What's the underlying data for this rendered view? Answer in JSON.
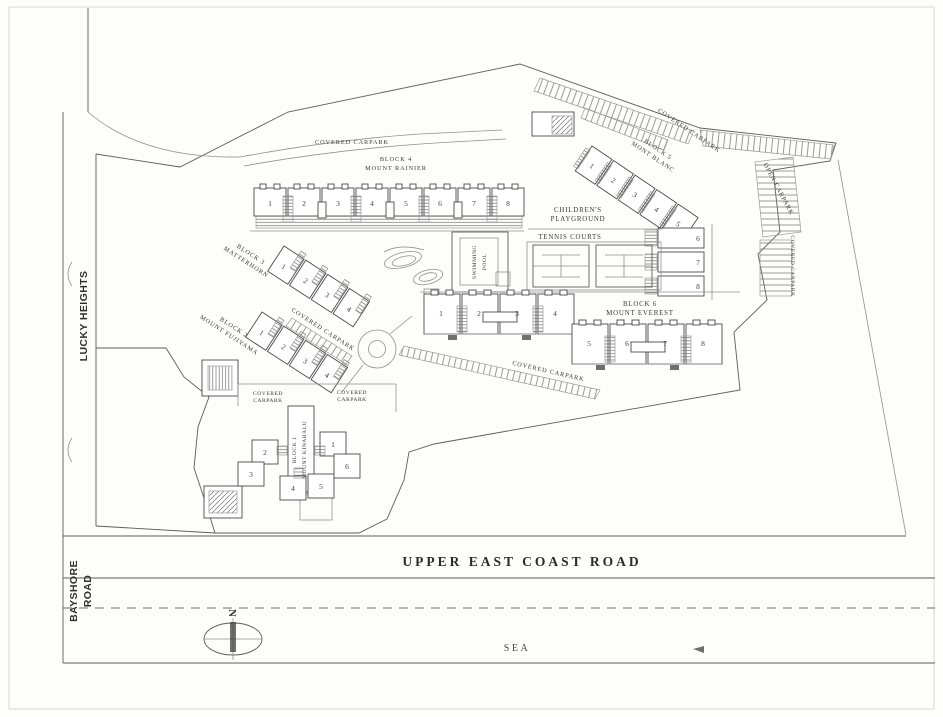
{
  "plan": {
    "roads": {
      "upper_east_coast_road": "UPPER EAST COAST ROAD",
      "bayshore_l1": "BAYSHORE",
      "bayshore_l2": "ROAD",
      "lucky_heights": "LUCKY HEIGHTS",
      "sea": "SEA"
    },
    "compass": {
      "north": "N"
    },
    "carparks": {
      "covered": "COVERED CARPARK",
      "covered_l1": "COVERED",
      "covered_l2": "CARPARK",
      "open": "OPEN CARPARK"
    },
    "amenities": {
      "playground_l1": "CHILDREN'S",
      "playground_l2": "PLAYGROUND",
      "tennis_courts": "TENNIS COURTS",
      "pool_l1": "SWIMMING",
      "pool_l2": "POOL"
    },
    "blocks": {
      "b1": {
        "l1": "BLOCK 1",
        "l2": "MOUNT KINABALU",
        "units": [
          "1",
          "2",
          "3",
          "4",
          "5",
          "6"
        ]
      },
      "b2": {
        "l1": "BLOCK 2",
        "l2": "MOUNT FUJIYAMA",
        "units": [
          "1",
          "2",
          "3",
          "4"
        ]
      },
      "b3": {
        "l1": "BLOCK 3",
        "l2": "MATTERHORN",
        "units": [
          "1",
          "2",
          "3",
          "4"
        ]
      },
      "b4": {
        "l1": "BLOCK 4",
        "l2": "MOUNT RAINIER",
        "units": [
          "1",
          "2",
          "3",
          "4",
          "5",
          "6",
          "7",
          "8"
        ]
      },
      "b5": {
        "l1": "BLOCK 5",
        "l2": "MONT BLANC",
        "units": [
          "1",
          "2",
          "3",
          "4",
          "5",
          "6",
          "7",
          "8"
        ]
      },
      "b6": {
        "l1": "BLOCK 6",
        "l2": "MOUNT EVEREST",
        "units": [
          "1",
          "2",
          "3",
          "4",
          "5",
          "6",
          "7",
          "8"
        ]
      }
    }
  }
}
